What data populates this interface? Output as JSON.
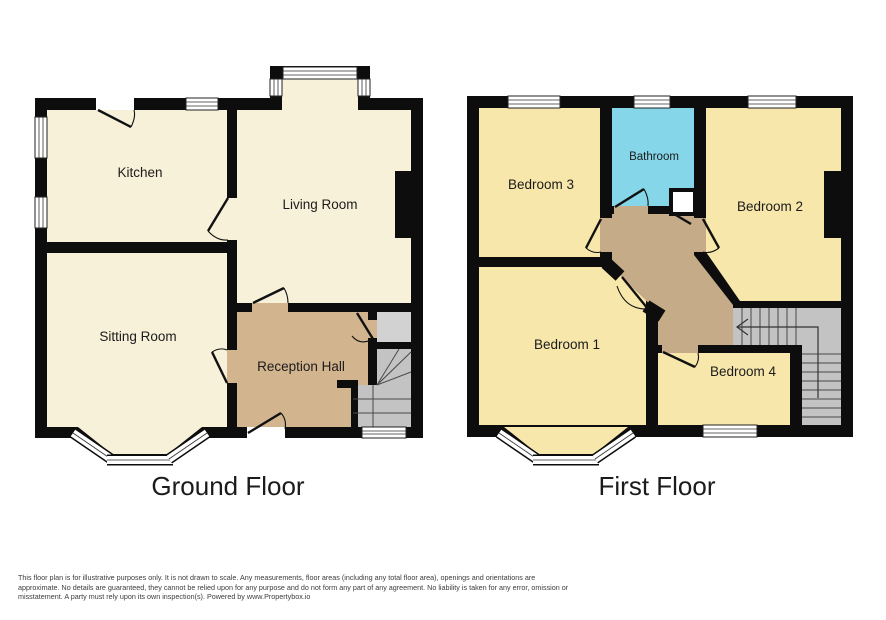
{
  "floors": [
    {
      "title": "Ground Floor",
      "rooms": [
        {
          "label": "Kitchen"
        },
        {
          "label": "Living Room"
        },
        {
          "label": "Sitting Room"
        },
        {
          "label": "Reception Hall"
        }
      ]
    },
    {
      "title": "First Floor",
      "rooms": [
        {
          "label": "Bedroom 3"
        },
        {
          "label": "Bathroom"
        },
        {
          "label": "Bedroom 2"
        },
        {
          "label": "Bedroom 1"
        },
        {
          "label": "Bedroom 4"
        }
      ]
    }
  ],
  "disclaimer": {
    "lines": [
      "This floor plan is for illustrative purposes only. It is not drawn to scale. Any measurements, floor areas (including any total floor area), openings and orientations are",
      "approximate. No details are guaranteed, they cannot be relied upon for any purpose and do not form any part of any agreement. No liability is taken for any error, omission or",
      "misstatement. A party must rely upon its own inspection(s). Powered by www.Propertybox.io"
    ]
  },
  "colors": {
    "background": "#ffffff",
    "wall": "#0d0d0d",
    "ground_room": "#f7f1da",
    "bedroom": "#f7e7ab",
    "hall": "#d2b48f",
    "landing": "#c6ab89",
    "bathroom": "#84d6e8",
    "stairs": "#c3c3c3",
    "stairs_light": "#d2d2d2",
    "label_text": "#1b1b1b",
    "disclaimer_text": "#3c3c3c"
  }
}
